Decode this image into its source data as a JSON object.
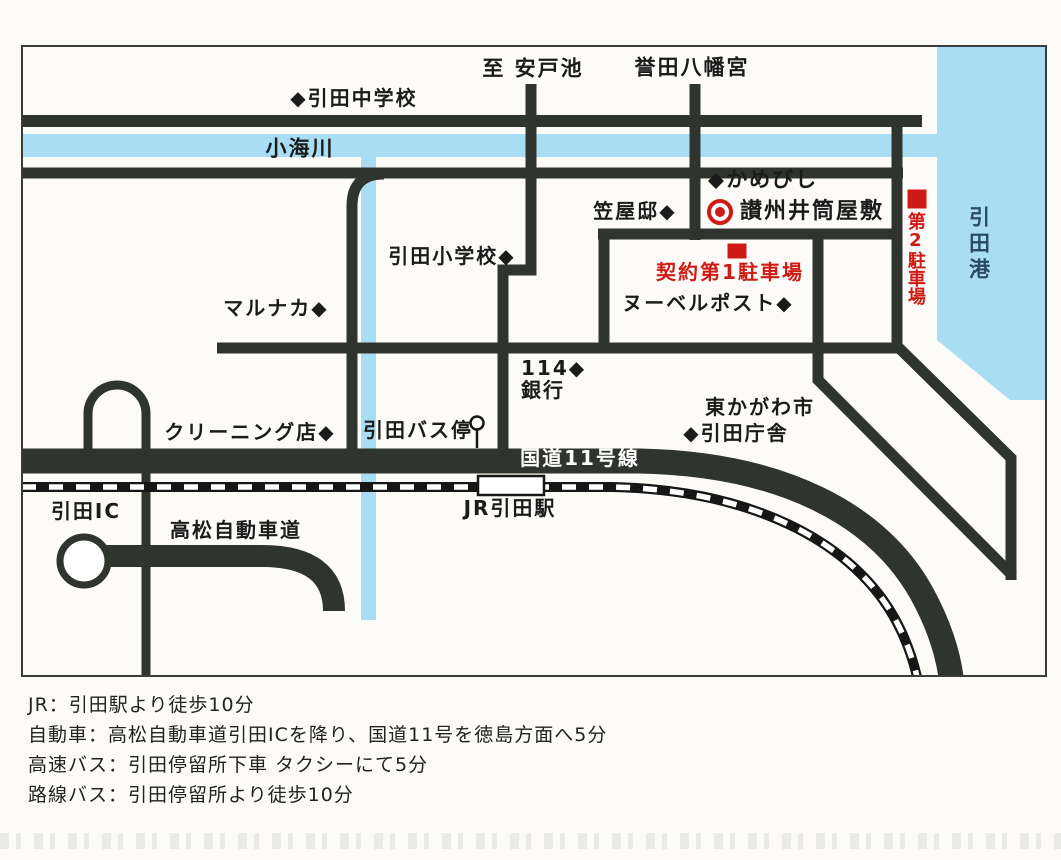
{
  "map": {
    "colors": {
      "sea": "#a8ddf4",
      "river": "#a8ddf4",
      "road": "#30342e",
      "accent_red": "#cf1b15",
      "port_text": "#2b4a63",
      "route11_text": "#ffffff",
      "paper": "#fcfbf7"
    },
    "labels": {
      "to_ando_pond": "至 安戸池",
      "honda_hachimangu": "誉田八幡宮",
      "hiketa_junior_high": "◆引田中学校",
      "komi_river": "小海川",
      "kamebishi": "◆かめびし",
      "kasaya_tei": "笠屋邸◆",
      "izutsu_yashiki": "讃州井筒屋敷",
      "parking2": "第2駐車場",
      "hiketa_port": "引田港",
      "hiketa_elementary": "引田小学校◆",
      "contract_parking1": "契約第1駐車場",
      "nouvelle_post": "ヌーベルポスト◆",
      "marunaka": "マルナカ◆",
      "bank114_line1": "114◆",
      "bank114_line2": "銀行",
      "cleaning_shop": "クリーニング店◆",
      "hiketa_bus_stop": "引田バス停",
      "higashikagawa_city": "東かがわ市",
      "hiketa_chosha": "◆引田庁舎",
      "route11": "国道11号線",
      "jr_hiketa_station": "JR引田駅",
      "hiketa_ic": "引田IC",
      "takamatsu_expressway": "高松自動車道"
    },
    "notes": [
      "JR：引田駅より徒歩10分",
      "自動車：高松自動車道引田ICを降り、国道11号を徳島方面へ5分",
      "高速バス：引田停留所下車 タクシーにて5分",
      "路線バス：引田停留所より徒歩10分"
    ]
  }
}
